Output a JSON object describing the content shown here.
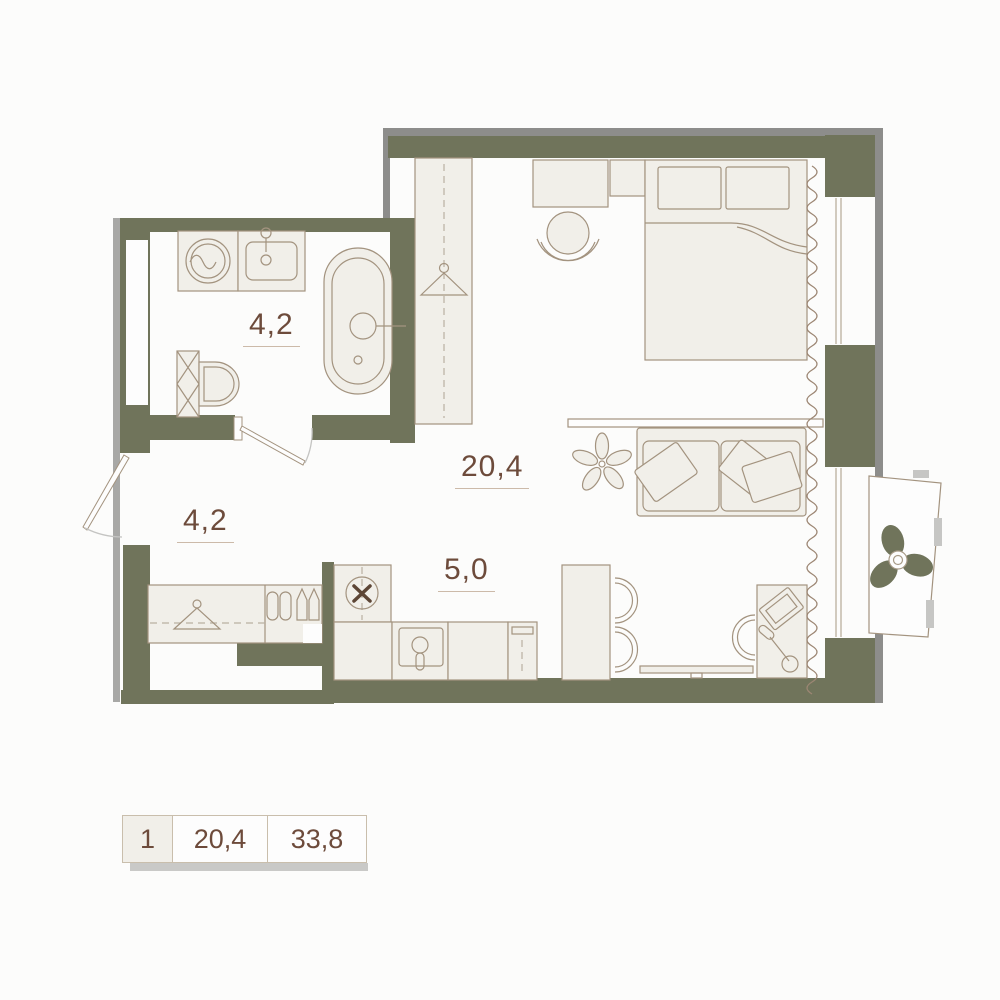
{
  "floor_plan": {
    "rooms": [
      {
        "id": "bathroom",
        "area_label": "4,2"
      },
      {
        "id": "hallway",
        "area_label": "4,2"
      },
      {
        "id": "living_room",
        "area_label": "20,4"
      },
      {
        "id": "kitchen",
        "area_label": "5,0"
      }
    ],
    "legend": {
      "rooms_count": "1",
      "living_area": "20,4",
      "total_area": "33,8"
    },
    "colors": {
      "wall": "#70745b",
      "furniture_fill": "#f1efe9",
      "furniture_stroke": "#a3937f",
      "label_text": "#6d4b3b",
      "shadow": "#8d8d8b",
      "legend_border": "#c9beac"
    },
    "furniture_icons": [
      "washing-machine",
      "bathroom-sink",
      "bathtub",
      "toilet",
      "coat-hanger",
      "slippers",
      "boots",
      "wardrobe",
      "desk",
      "desk-chair",
      "bed",
      "pillows",
      "shelf",
      "sofa",
      "plant",
      "dining-table",
      "dining-chairs",
      "tv",
      "kitchen-stove",
      "kitchen-sink",
      "oven",
      "laptop",
      "desk-lamp",
      "curtain",
      "window",
      "balcony",
      "fan"
    ]
  }
}
